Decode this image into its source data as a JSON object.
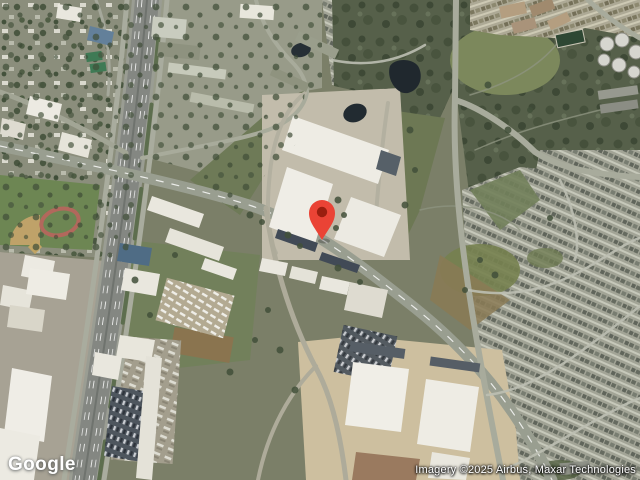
{
  "map": {
    "view": "satellite",
    "branding": {
      "logo_text": "Google"
    },
    "attribution": {
      "text": "Imagery ©2025 Airbus, Maxar Technologies"
    },
    "marker": {
      "pin_color": "#EA4335",
      "dot_color": "#9A1E0F",
      "position": {
        "x": 322,
        "y": 240
      }
    }
  },
  "palette": {
    "scrub_dark": "#56604a",
    "field_green": "#72805b",
    "road_gray": "#9aa092",
    "highway_gray": "#848782",
    "building_white": "#eeece4",
    "sand_tan": "#cdbf9f",
    "water_dark": "#232c33"
  }
}
